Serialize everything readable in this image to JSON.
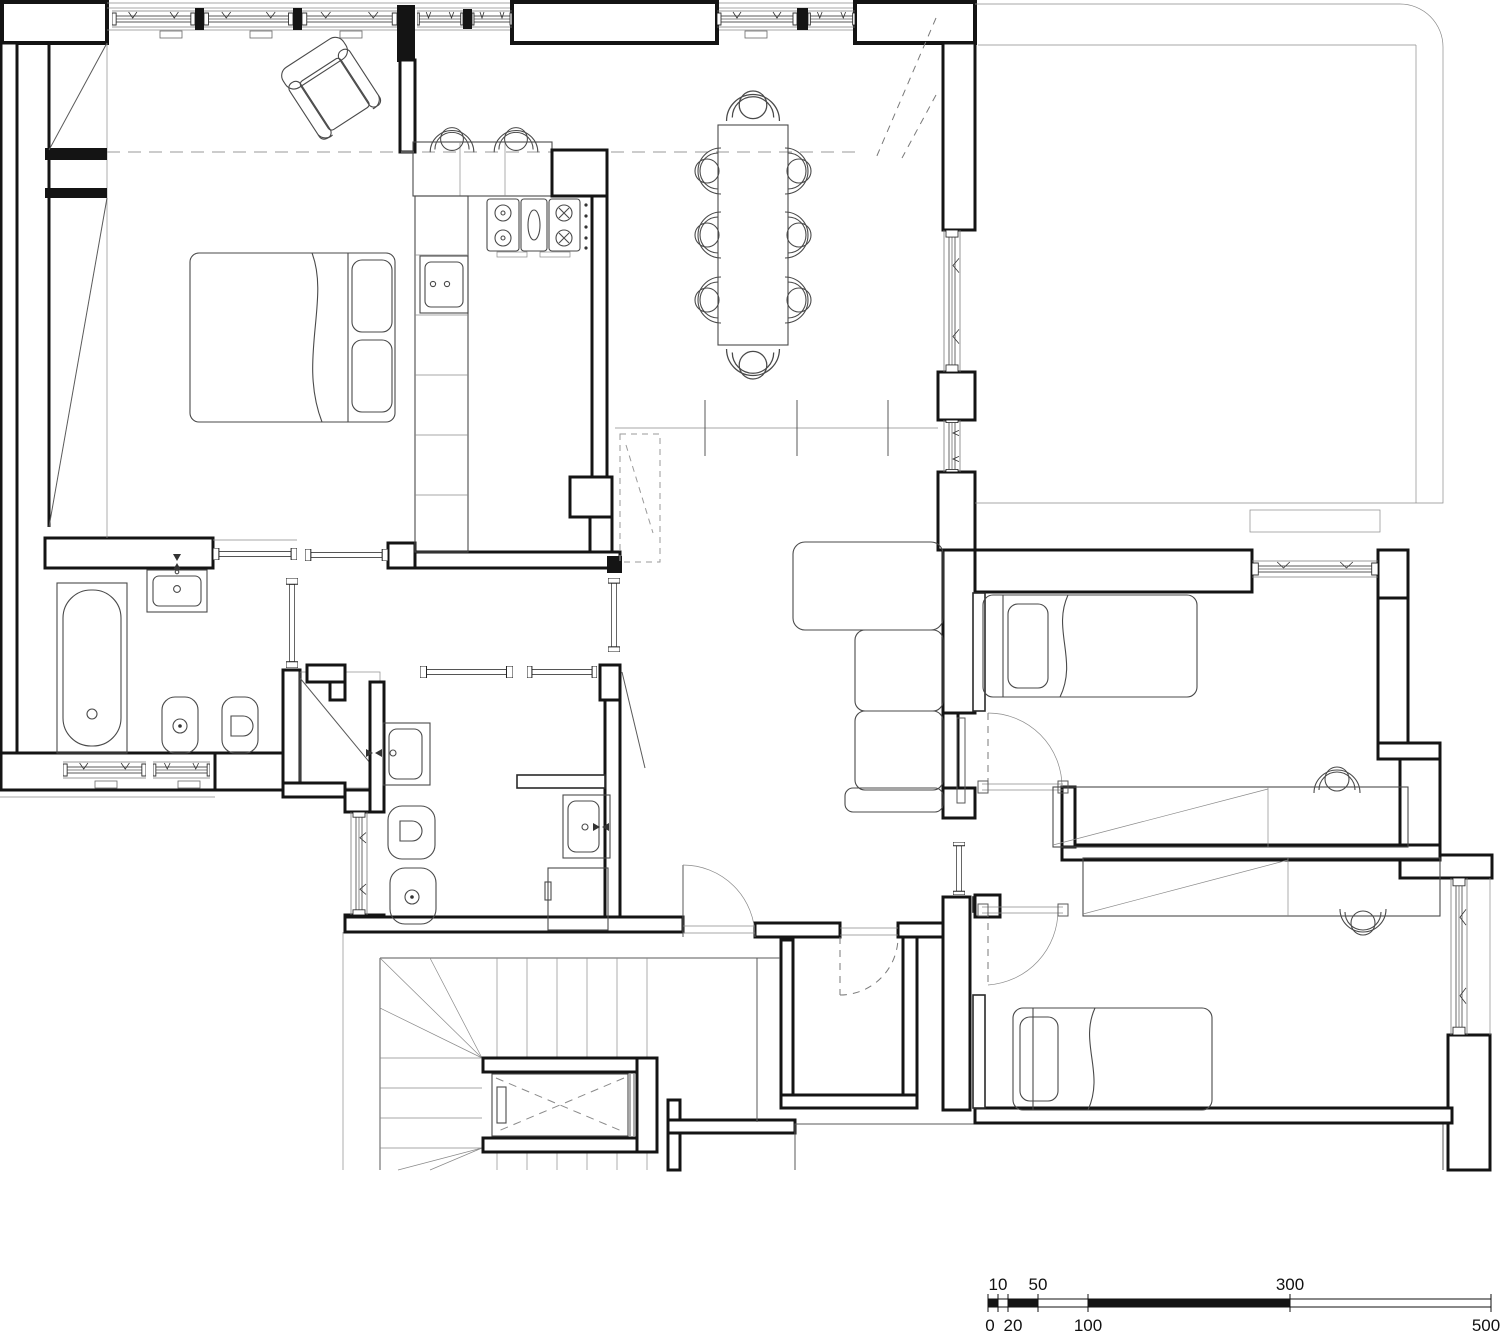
{
  "document": {
    "type": "architectural floor plan",
    "description": "black and white apartment floor plan with furniture, fixtures, stair core with elevator, terrace and measuring scale bar",
    "background_color": "#ffffff",
    "line_color": "#141414"
  },
  "symbols": [
    "double-bed",
    "armchair",
    "wardrobe",
    "kitchen-counter",
    "gas-stove",
    "kitchen-sink",
    "bar-stool",
    "dining-table",
    "dining-chair",
    "sofa",
    "bathtub",
    "washbasin",
    "toilet",
    "bidet",
    "washing-machine",
    "single-bed",
    "desk",
    "desk-chair",
    "staircase",
    "elevator",
    "window",
    "door-swing",
    "sliding-door",
    "shutoff-valve",
    "radiator"
  ],
  "scale_bar": {
    "labels_above": {
      "l10": "10",
      "l50": "50",
      "l300": "300"
    },
    "labels_below": {
      "l0": "0",
      "l20": "20",
      "l100": "100",
      "l500": "500"
    }
  }
}
